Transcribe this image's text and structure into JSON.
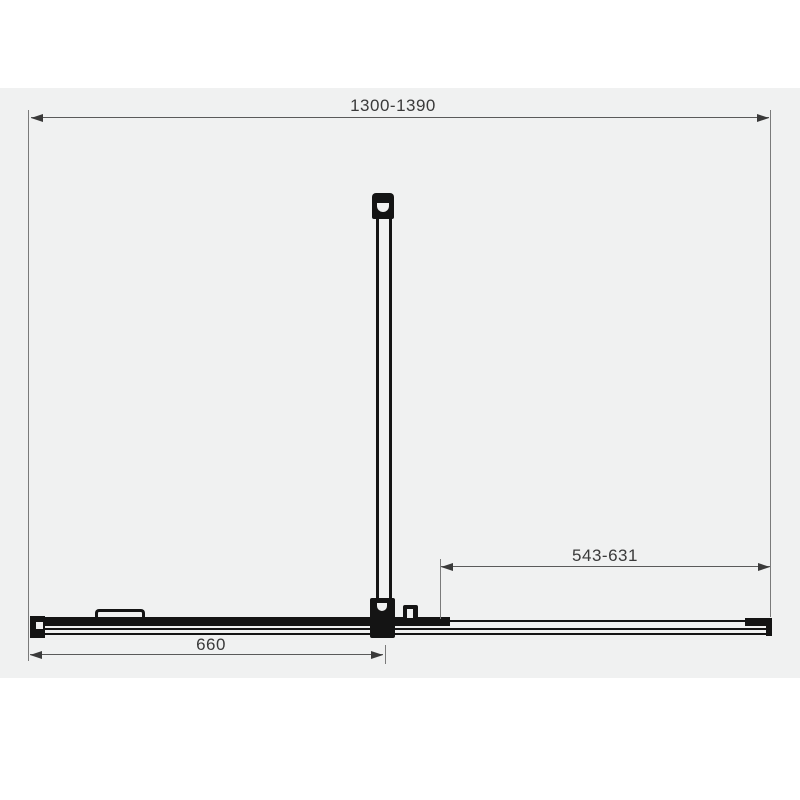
{
  "drawing": {
    "title": "shower-enclosure-plan-view-technical-drawing",
    "dimensions": {
      "overall_width": {
        "label": "1300-1390"
      },
      "door_width": {
        "label": "543-631"
      },
      "fixed_panel_width": {
        "label": "660"
      }
    },
    "colors": {
      "page_background": "#ffffff",
      "panel_background": "#f0f1f1",
      "dimension_line": "#5a5a5a",
      "shape": "#141414",
      "text": "#3a3a3a"
    }
  }
}
